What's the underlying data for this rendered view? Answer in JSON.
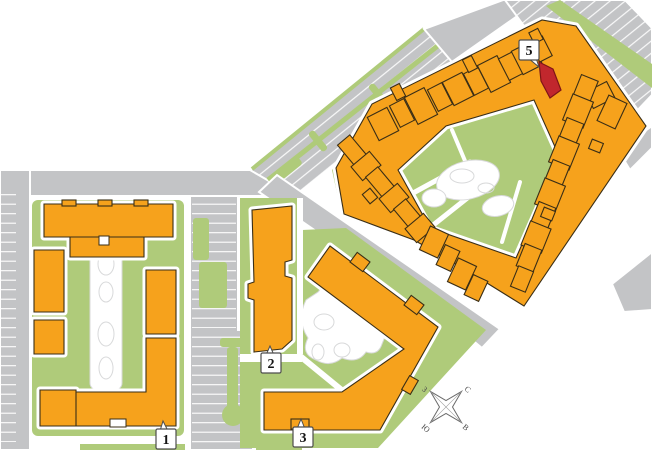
{
  "map": {
    "title": "apartment-site-plan",
    "colors": {
      "building": "#F6A21C",
      "building_outline": "#3A2E16",
      "highlight": "#C1272D",
      "highlight_outline": "#7E1417",
      "green": "#AFCB7A",
      "road": "#C3C4C6",
      "path_outline": "#D8D9DA",
      "label_border": "#4D4D4D",
      "label_text": "#141414"
    },
    "buildings": [
      {
        "id": "1",
        "label": "1"
      },
      {
        "id": "2",
        "label": "2"
      },
      {
        "id": "3",
        "label": "3"
      },
      {
        "id": "5",
        "label": "5"
      }
    ],
    "highlighted_unit": {
      "building": "5"
    },
    "compass": {
      "north": "С",
      "south": "Ю",
      "west": "З",
      "east": "В"
    }
  }
}
